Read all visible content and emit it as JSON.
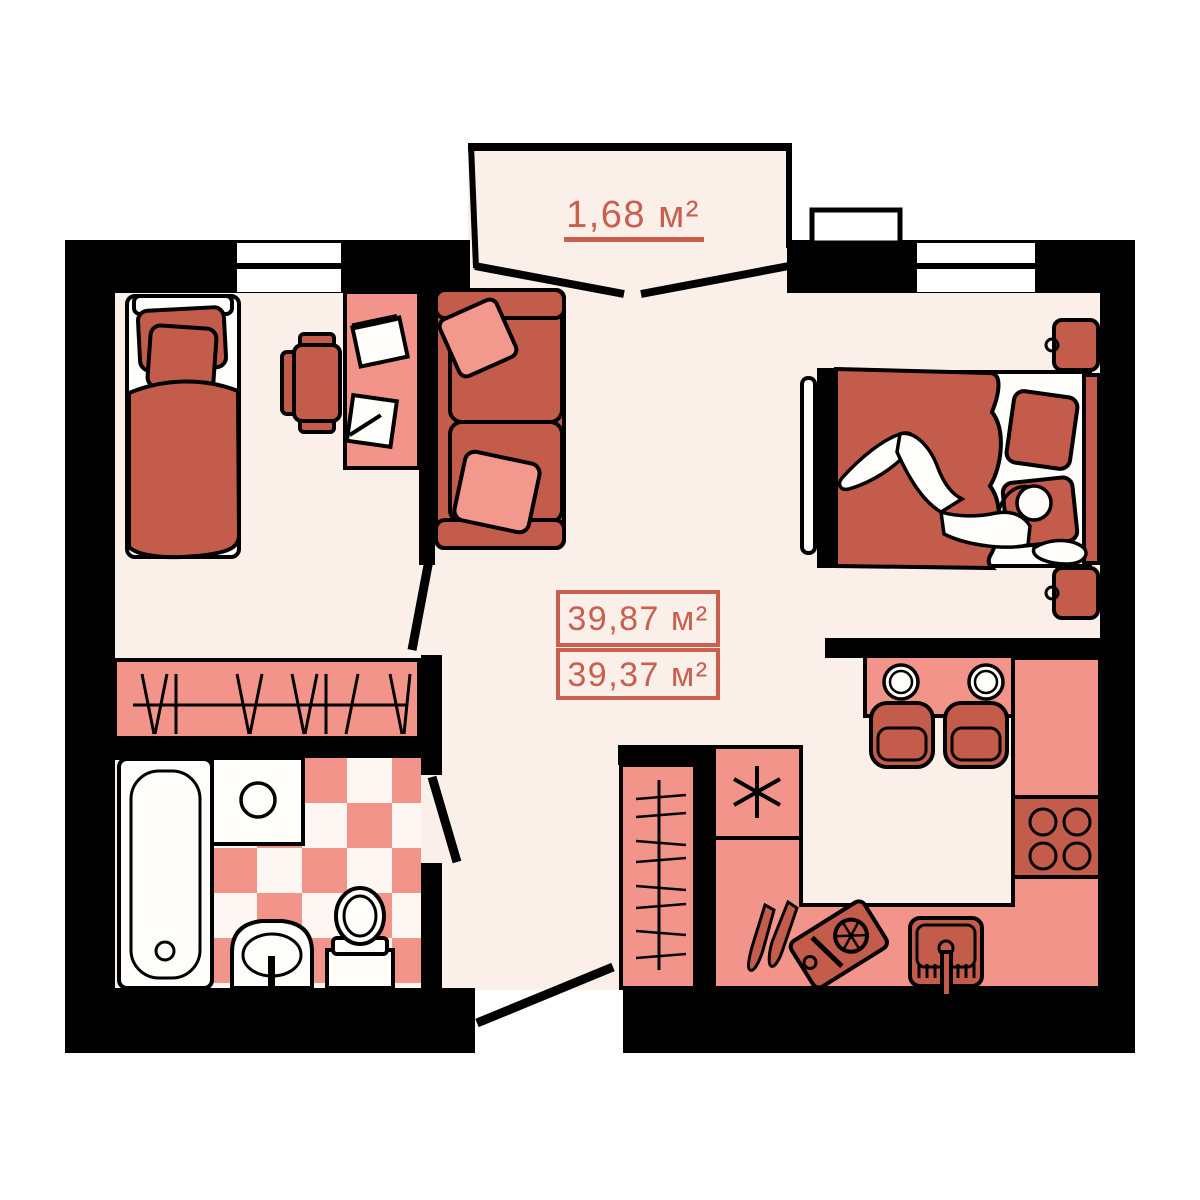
{
  "plan": {
    "type": "apartment-floor-plan",
    "balcony": {
      "area_label": "1,68 м²"
    },
    "area_summary": {
      "total_area": "39,87 м²",
      "living_area": "39,37 м²"
    },
    "colors": {
      "background": "#FFFFFF",
      "floor": "#FBEFEA",
      "walls": "#000000",
      "furniture_light_salmon": "#F2948A",
      "furniture_dark_red": "#C35C4B",
      "accent_text": "#C9604F"
    },
    "elements": [
      "balcony",
      "window",
      "single-bed",
      "desk",
      "desk-chair",
      "papers",
      "sofa",
      "pillows",
      "closet-hangers",
      "bathtub",
      "washing-machine",
      "bathroom-sink",
      "toilet",
      "checker-tiles",
      "double-bed",
      "person",
      "nightstands",
      "wardrobe-hangers",
      "fridge",
      "kitchen-counter",
      "stove",
      "kitchen-sink",
      "bar-table",
      "bar-chairs",
      "cutting-board",
      "knives",
      "door-swings"
    ]
  }
}
